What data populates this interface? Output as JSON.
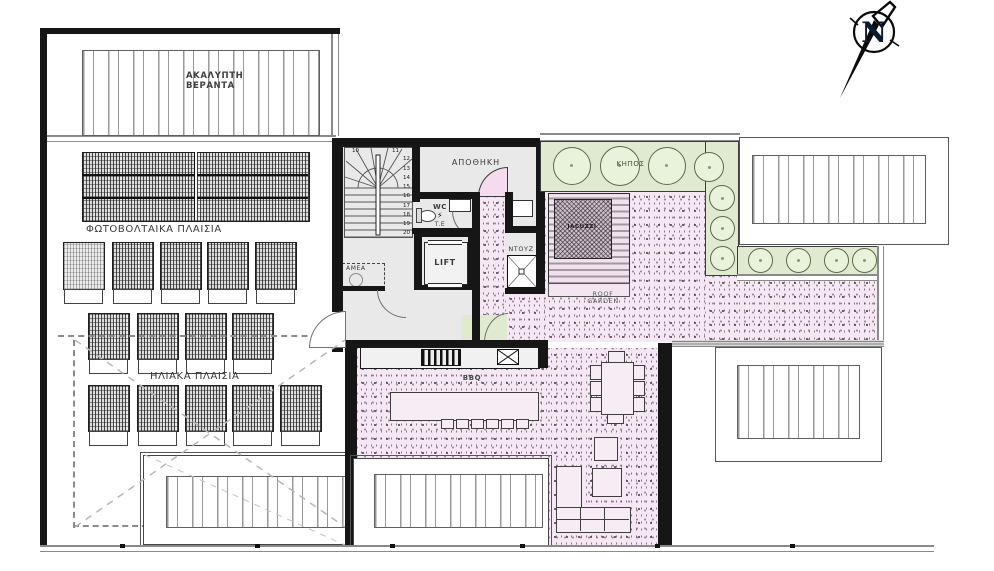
{
  "labels": {
    "veranda_line1": "ΑΚΑΛΥΠΤΗ",
    "veranda_line2": "ΒΕΡΑΝΤΑ",
    "photovoltaic_panels": "ΦΩΤΟΒΟΛΤΑΙΚΑ ΠΛΑΙΣΙΑ",
    "solar_panels": "ΗΛΙΑΚΑ ΠΛΑΙΣΙΑ",
    "storage": "ΑΠΟΘΗΚΗ",
    "wc": "WC",
    "electrical": "T.E",
    "lift": "LIFT",
    "accessible": "ΑΜΕΑ",
    "shower": "ΝΤΟΥΖ",
    "bbq": "BBQ",
    "jacuzzi": "JACUZZI",
    "planting": "ΚΗΠΟΣ",
    "roof_garden_line1": "ROOF",
    "roof_garden_line2": "GARDEN",
    "north": "N"
  },
  "stairs": {
    "numbers": [
      "10",
      "11",
      "12",
      "13",
      "14",
      "15",
      "16",
      "17",
      "18",
      "19",
      "20"
    ]
  },
  "colors": {
    "pink_paving": "#f5e7f3",
    "green_planting": "#dfead0",
    "wall": "#161616",
    "room_fill": "#e9e9e9",
    "door_pink": "#f4dbee"
  }
}
